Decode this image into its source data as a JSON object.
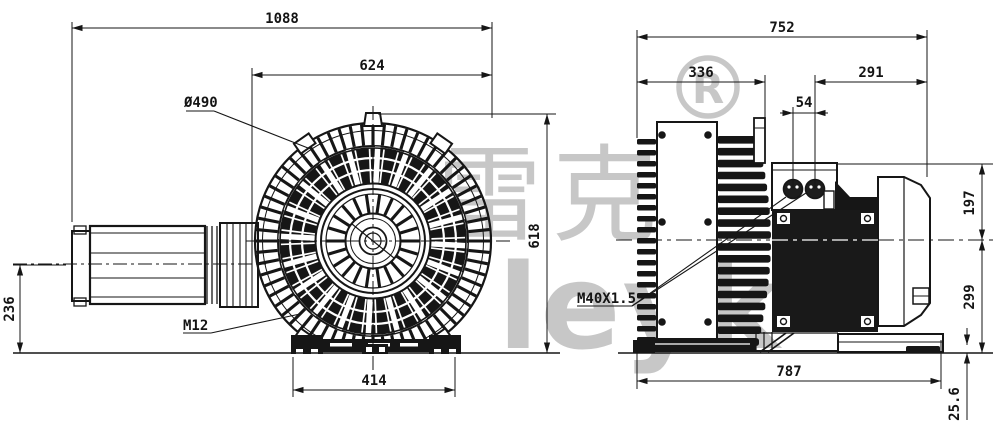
{
  "watermark": {
    "cn_text": "雷克",
    "latin_text": "leyk",
    "registered_symbol": "R"
  },
  "front_view": {
    "overall_width": "1088",
    "inlet_width": "624",
    "impeller_diameter": "Ø490",
    "overall_height": "618",
    "inlet_axis_height": "236",
    "mounting_thread": "M12",
    "foot_spacing": "414"
  },
  "side_view": {
    "overall_depth": "752",
    "blower_depth": "336",
    "motor_length": "291",
    "gland_offset": "54",
    "top_to_axis_height": "197",
    "axis_to_base_height": "299",
    "base_length": "787",
    "foot_height": "25.6",
    "cable_gland_thread": "M40X1.5"
  }
}
